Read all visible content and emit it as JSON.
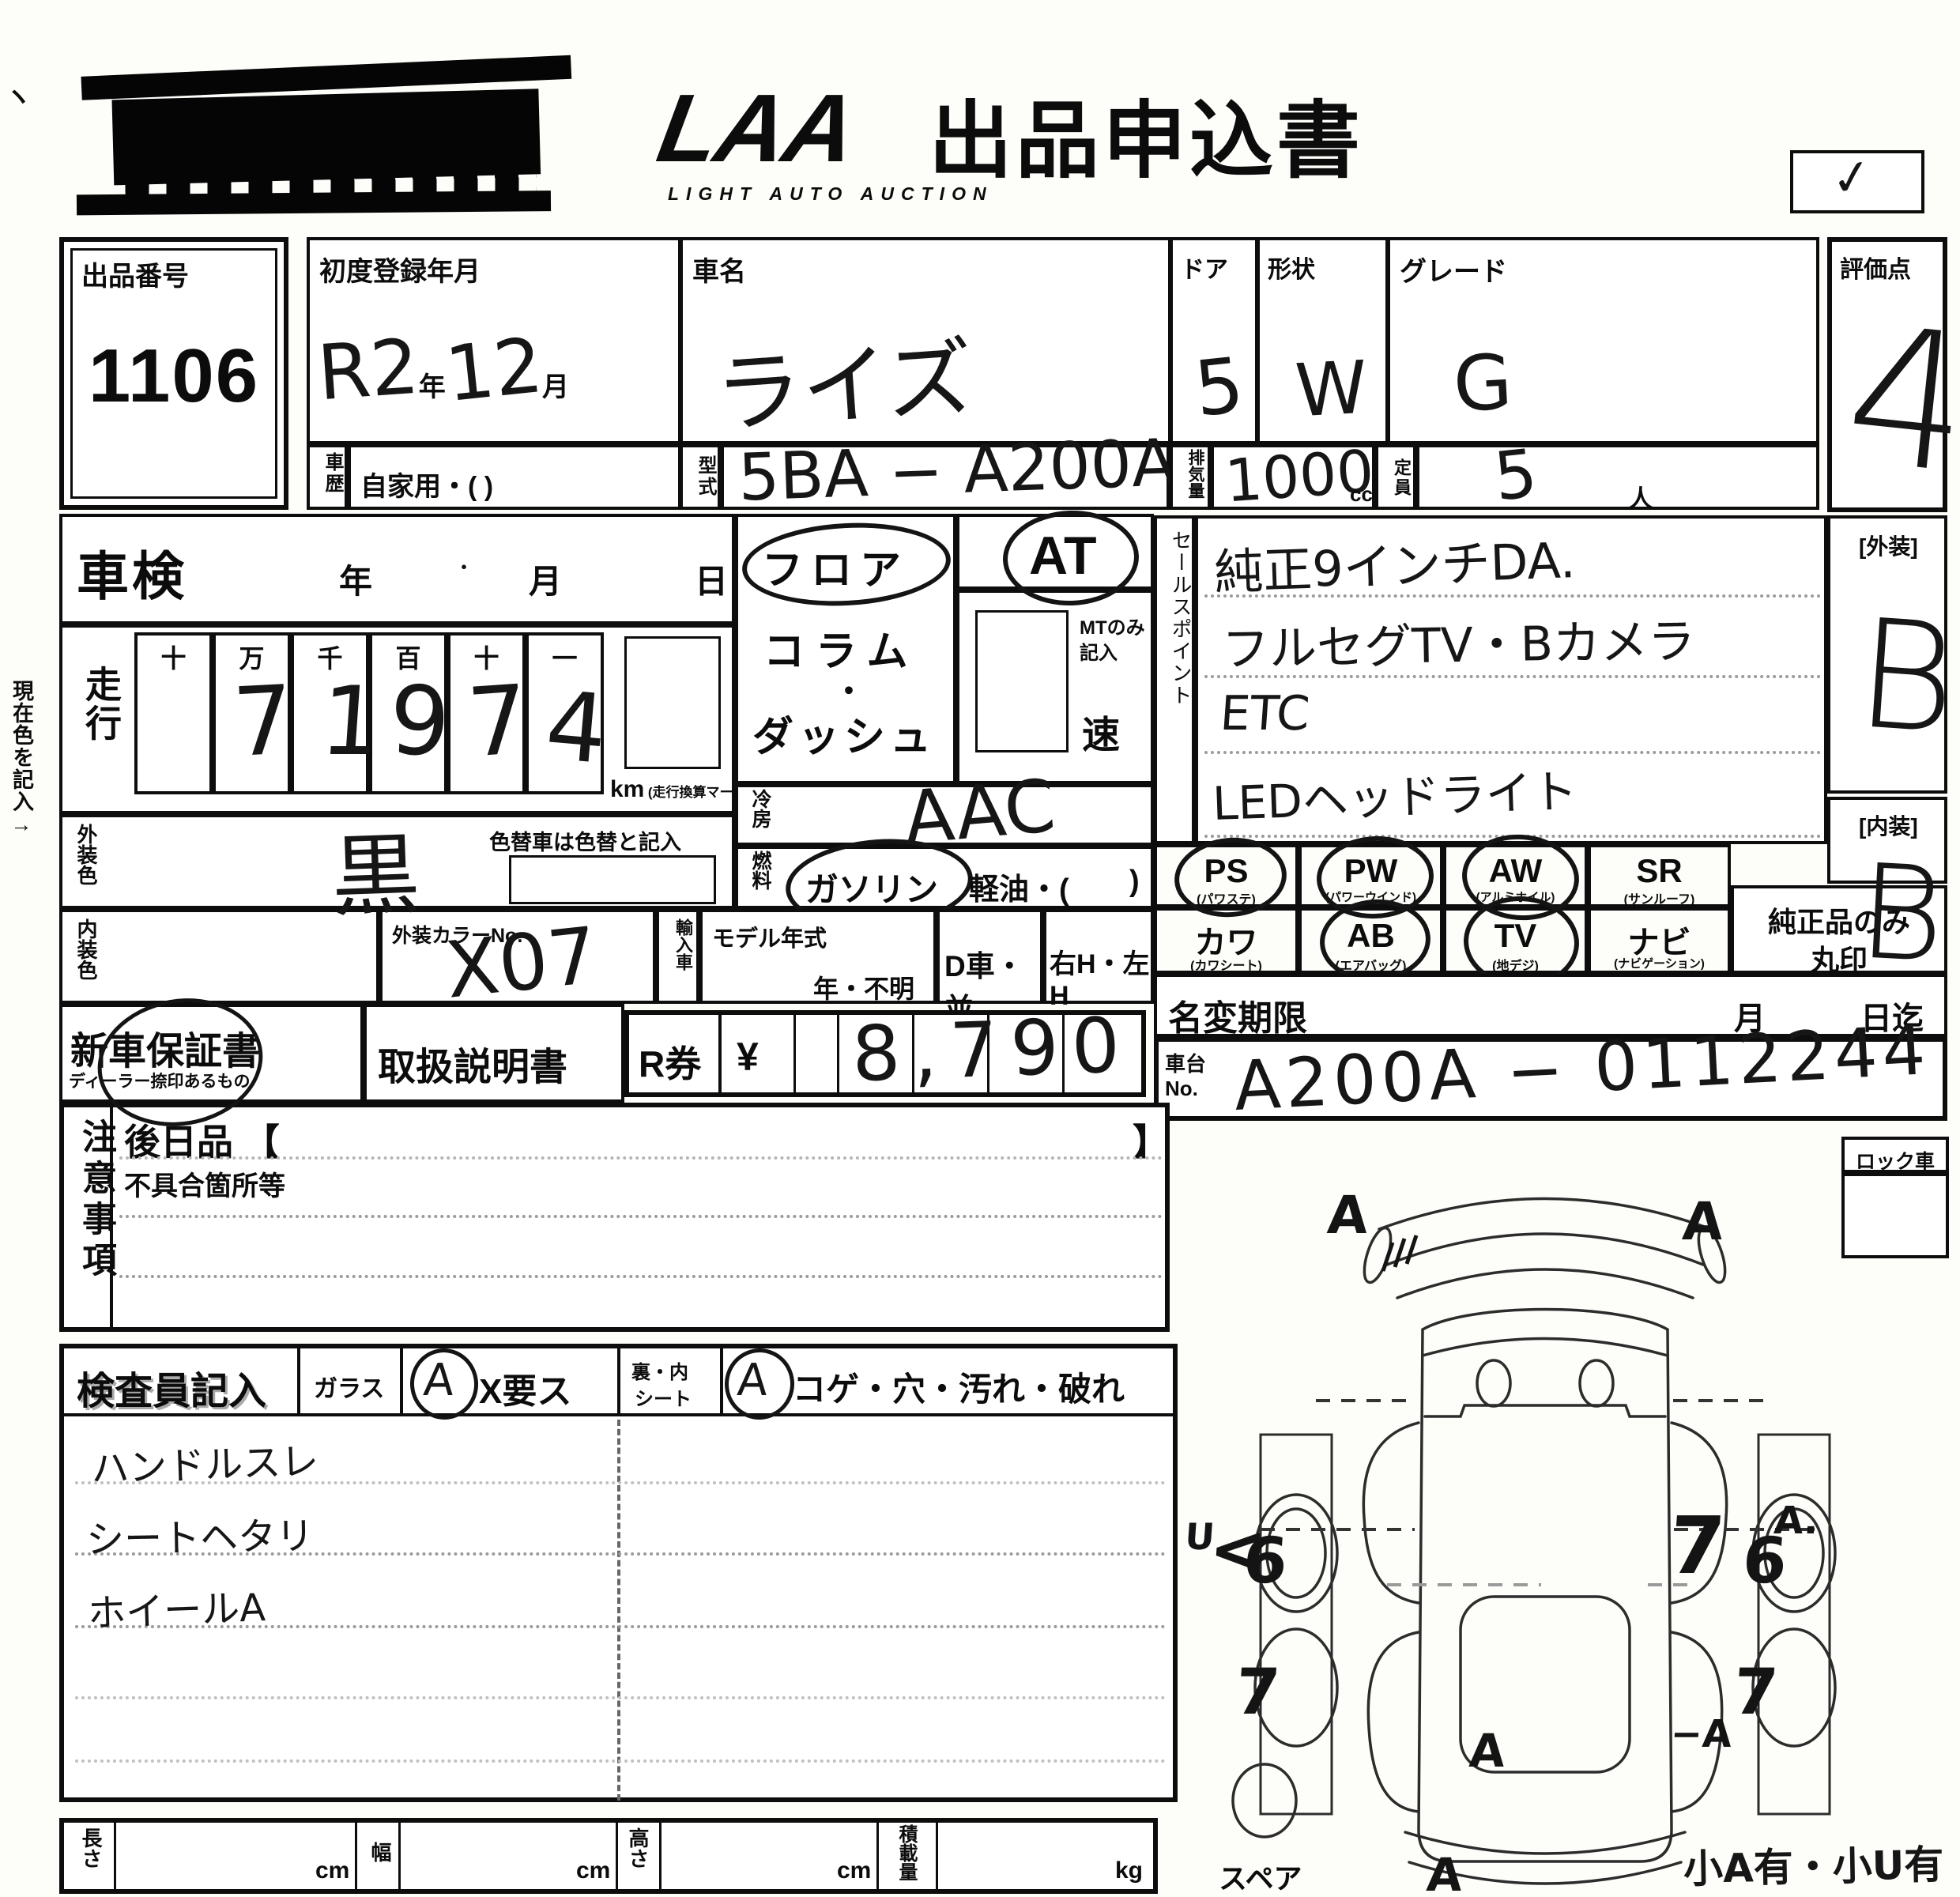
{
  "header": {
    "logo": "LAA",
    "logo_sub": "LIGHT AUTO AUCTION",
    "title": "出品申込書",
    "check": "✓"
  },
  "top": {
    "lot_label": "出品番号",
    "lot_number": "1106",
    "first_reg_label": "初度登録年月",
    "first_reg_era": "R2",
    "year_suffix": "年",
    "first_reg_month": "12",
    "month_suffix": "月",
    "car_name_label": "車名",
    "car_name": "ライズ",
    "door_label": "ドア",
    "door": "5",
    "shape_label": "形状",
    "shape": "W",
    "grade_label": "グレード",
    "grade": "G",
    "history_label": "車歴",
    "history": "自家用・(            )",
    "model_code_label": "型式",
    "model_code": "5BA − A200A",
    "disp_label": "排気量",
    "disp": "1000",
    "disp_unit": "cc",
    "cap_label": "定員",
    "cap": "5",
    "cap_unit": "人",
    "score_label": "評価点",
    "score": "4"
  },
  "shaken": {
    "label": "車検",
    "year": "年",
    "month": "月",
    "day": "日"
  },
  "mileage": {
    "label": "走行",
    "headers": [
      "十",
      "万",
      "千",
      "百",
      "十",
      "一"
    ],
    "digits": [
      "",
      "7",
      "1",
      "9",
      "7",
      "4"
    ],
    "unit": "km",
    "unit_note": "(走行換算マーク記入)"
  },
  "colors": {
    "current_note": "現在色を記入→",
    "ext_label": "外装色",
    "ext": "黒",
    "recolor_note": "色替車は色替と記入",
    "int_label": "内装色",
    "color_no_label": "外装カラーNo.",
    "color_no": "X07"
  },
  "shift": {
    "floor": "フロア",
    "column": "コラム",
    "middot": "・",
    "dash": "ダッシュ",
    "at": "AT",
    "mt_note1": "MTのみ",
    "mt_note2": "記入",
    "speed": "速"
  },
  "aircon": {
    "label": "冷房",
    "value": "AAC"
  },
  "fuel": {
    "label": "燃料",
    "gas": "ガソリン",
    "diesel": "軽油・(",
    "close": ")"
  },
  "sales": {
    "label": "セールスポイント",
    "lines": [
      "純正9インチDA.",
      "フルセグTV・Bカメラ",
      "ETC",
      "LEDヘッドライト"
    ]
  },
  "ratings": {
    "ext_label": "[外装]",
    "ext": "B",
    "int_label": "[内装]",
    "int": "B",
    "genuine1": "純正品のみ",
    "genuine2": "丸印"
  },
  "equipment": {
    "row1": [
      {
        "code": "PS",
        "sub": "(パワステ)"
      },
      {
        "code": "PW",
        "sub": "(パワーウインド)"
      },
      {
        "code": "AW",
        "sub": "(アルミホイル)"
      },
      {
        "code": "SR",
        "sub": "(サンルーフ)"
      }
    ],
    "row2": [
      {
        "code": "カワ",
        "sub": "(カワシート)"
      },
      {
        "code": "AB",
        "sub": "(エアバッグ)"
      },
      {
        "code": "TV",
        "sub": "(地デジ)"
      },
      {
        "code": "ナビ",
        "sub": "(ナビゲーション)"
      }
    ]
  },
  "import": {
    "label": "輸入車",
    "model_year_label": "モデル年式",
    "model_year": "年・不明",
    "d_car": "D車・並",
    "handle": "右H・左H"
  },
  "warranty": {
    "new_label": "新車保証書",
    "new_sub": "ディーラー捺印あるもの",
    "manual": "取扱説明書",
    "r_label": "R券",
    "yen": "¥",
    "amount": "8,790"
  },
  "transfer": {
    "label": "名変期限",
    "month": "月",
    "until": "日迄"
  },
  "chassis": {
    "label1": "車台",
    "label2": "No.",
    "value": "A200A − 0112244"
  },
  "notes": {
    "label": "注意事項",
    "later": "後日品 【",
    "later_close": "】",
    "defect": "不具合箇所等"
  },
  "inspector": {
    "label": "検査員記入",
    "glass": "ガラス",
    "glass_mark": "A",
    "glass_note": "X要ス",
    "seat1": "裏・内",
    "seat2": "シート",
    "seat_mark": "A",
    "seat_note": "コゲ・穴・汚れ・破れ",
    "notes": [
      "ハンドルスレ",
      "シートヘタリ",
      "ホイールA"
    ]
  },
  "dims": {
    "len": "長さ",
    "width": "幅",
    "height": "高さ",
    "load": "積載量",
    "cm": "cm",
    "kg": "kg"
  },
  "diagram": {
    "lock": "ロック車",
    "spare": "スペア",
    "corner_note": "小A有・小U有",
    "marks": {
      "rear_left": "A",
      "rear_right": "A",
      "rw_l": "6",
      "rw_r": "6",
      "fw_l": "7",
      "fw_r": "7",
      "side_l": "AU",
      "arrow_l": "<",
      "side_r": "7",
      "side_r_a": "A.",
      "front_r": "−A",
      "windshield": "A",
      "front": "A"
    }
  }
}
